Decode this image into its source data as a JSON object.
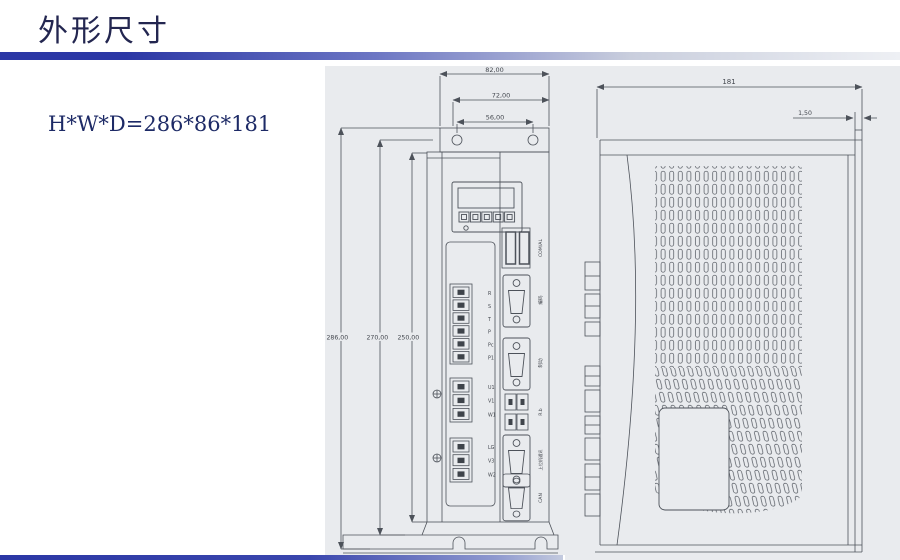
{
  "slide": {
    "title": "外形尺寸",
    "size_note": "H*W*D=286*86*181"
  },
  "front_view": {
    "dims_top": [
      "82,00",
      "72,00",
      "56,00"
    ],
    "dims_left": [
      "286,00",
      "270,00",
      "250,00"
    ],
    "power_terminals": [
      "R",
      "S",
      "T",
      "P",
      "Pc",
      "P1"
    ],
    "motor_terminals": [
      "U1",
      "V1",
      "W1"
    ],
    "aux_terminals": [
      "LG",
      "V3",
      "W2"
    ],
    "connector_labels": [
      "COM/AL",
      "编码",
      "制动",
      "R.b",
      "上位机通讯",
      "CAN"
    ]
  },
  "side_view": {
    "dim_depth": "181",
    "dim_plate": "1,50"
  },
  "colors": {
    "accent_bar": "#2b37a5",
    "panel": "#e9ebee",
    "drawing_line": "#4d525a",
    "title_text": "#232650"
  }
}
